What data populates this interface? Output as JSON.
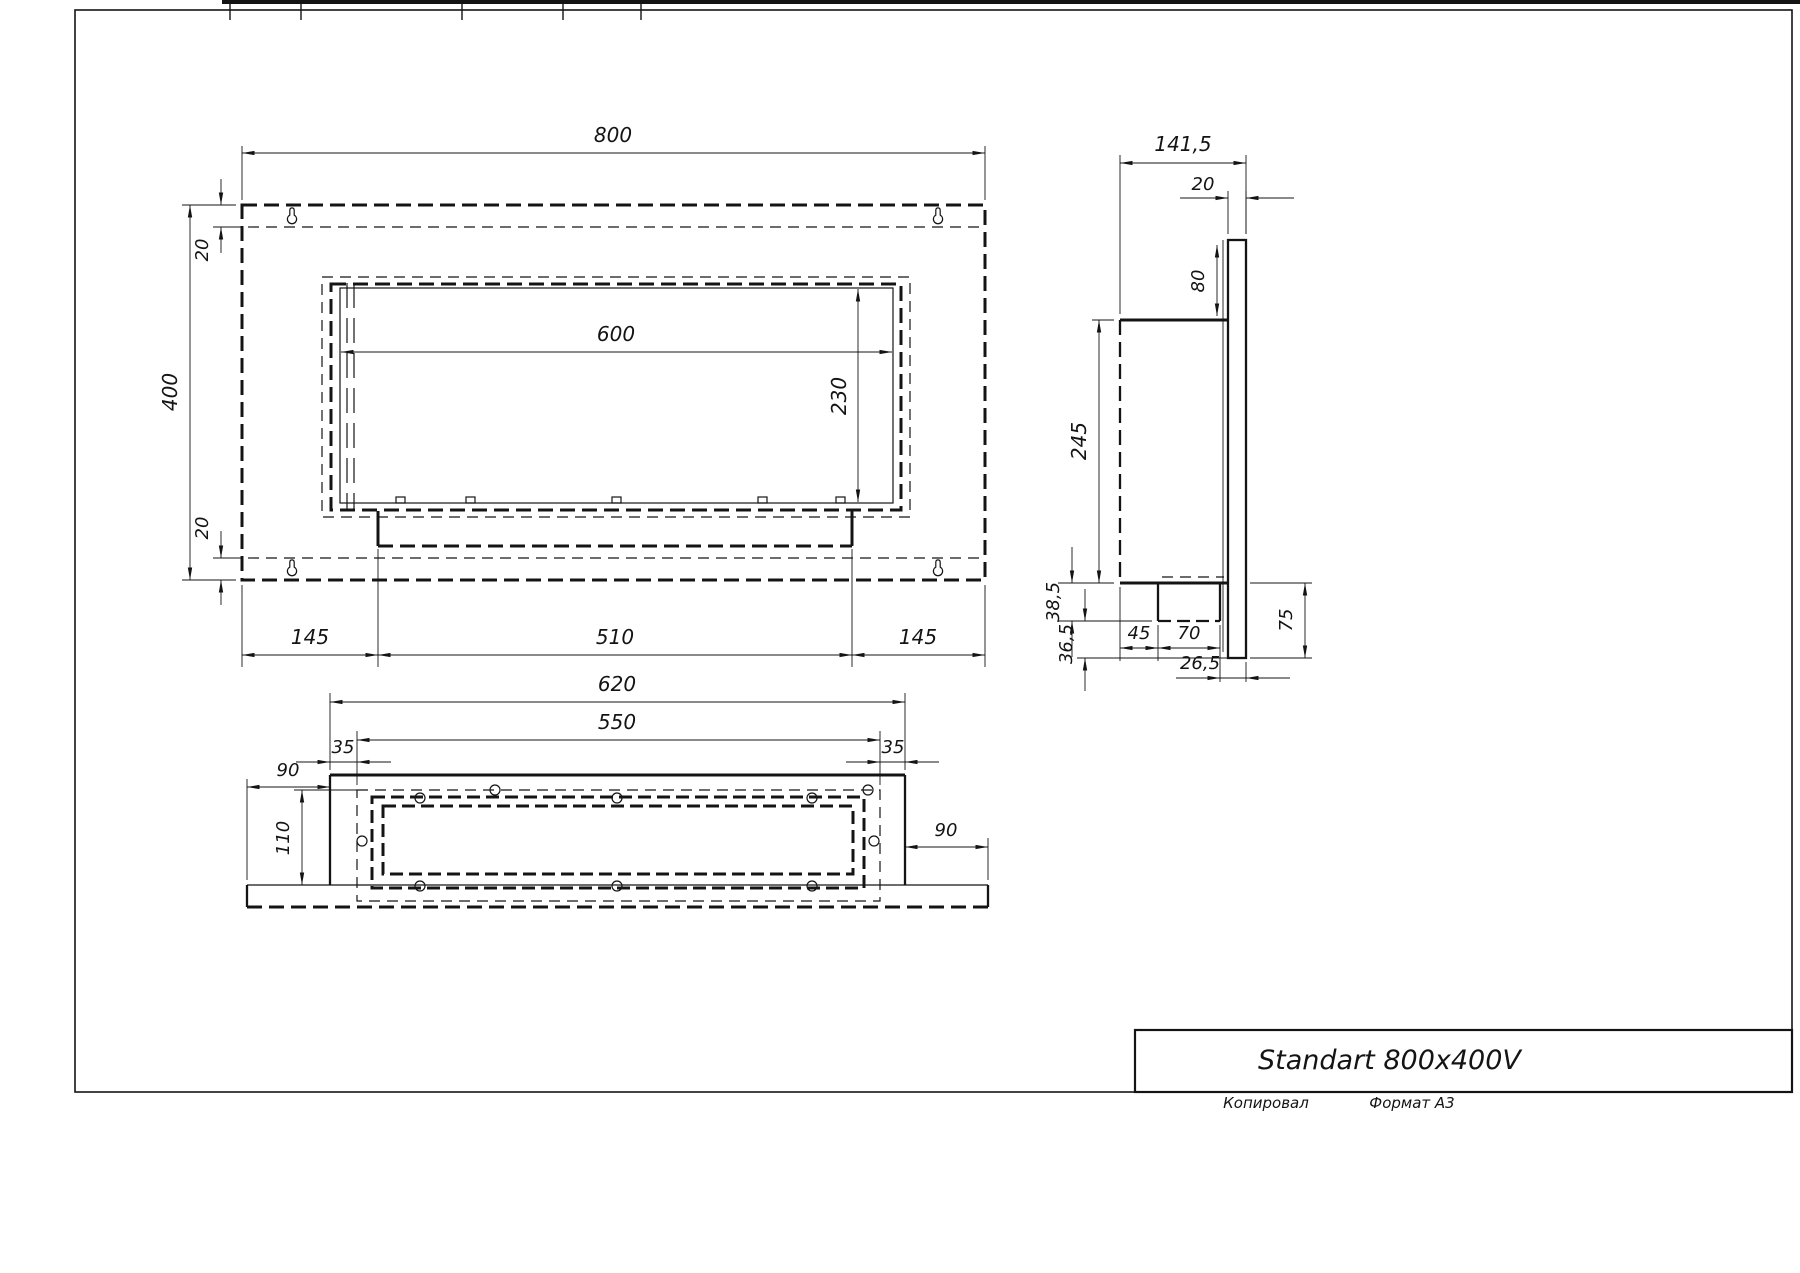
{
  "sheet": {
    "footer_copied": "Копировал",
    "footer_format": "Формат А3"
  },
  "title_block": {
    "title": "Standart 800x400V"
  },
  "front_view": {
    "width": "800",
    "height": "400",
    "top_offset": "20",
    "bottom_offset": "20",
    "opening_width": "600",
    "opening_height": "230",
    "bottom_left": "145",
    "bottom_center": "510",
    "bottom_right": "145"
  },
  "side_view": {
    "depth": "141,5",
    "plate_thickness": "20",
    "plate_top_height": "80",
    "body_height": "245",
    "burner_drop": "38,5",
    "burner_offset": "45",
    "burner_depth": "70",
    "back_gap": "26,5",
    "lower_gap": "36,5",
    "plate_below": "75"
  },
  "bottom_view": {
    "body_width": "620",
    "opening_width": "550",
    "inset_left": "35",
    "inset_right": "35",
    "overhang_left": "90",
    "depth": "110",
    "overhang_right": "90"
  }
}
